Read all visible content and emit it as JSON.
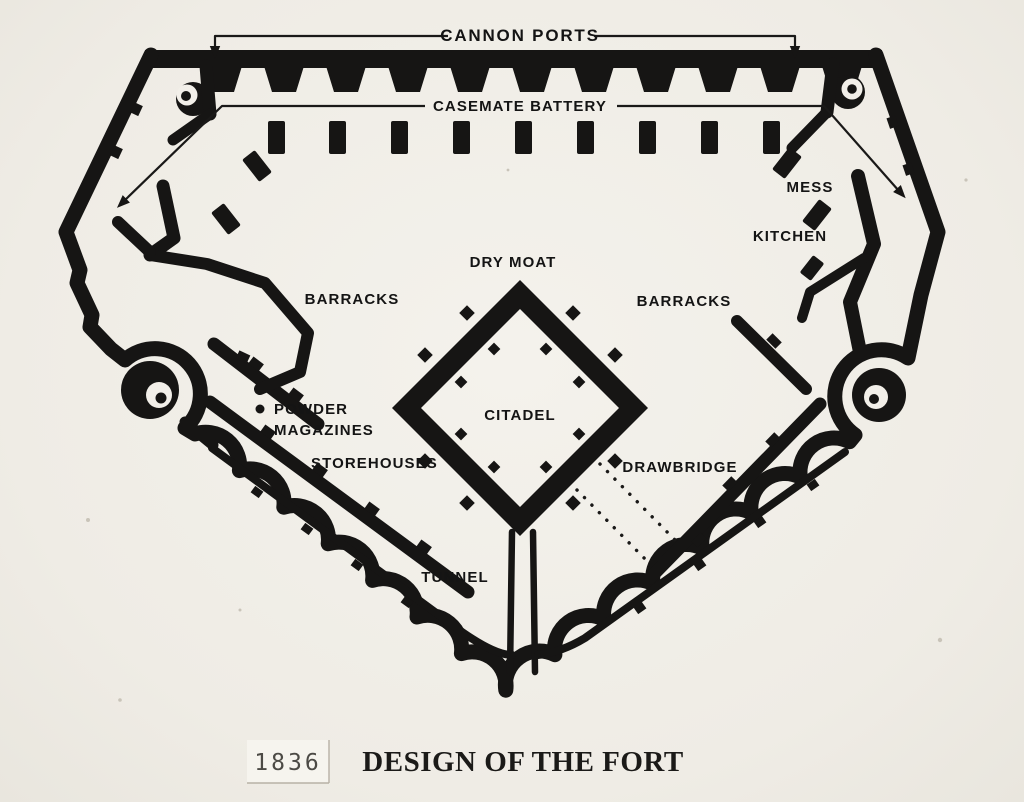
{
  "palette": {
    "paper": "#f1eee8",
    "ink": "#161514",
    "year_text": "#4c4a45",
    "year_box": "#f6f4ee"
  },
  "labels": {
    "cannon_ports": "CANNON PORTS",
    "casemate_battery": "CASEMATE BATTERY",
    "mess": "MESS",
    "kitchen": "KITCHEN",
    "dry_moat": "DRY MOAT",
    "barracks_left": "BARRACKS",
    "barracks_right": "BARRACKS",
    "citadel": "CITADEL",
    "powder_magazines": [
      "POWDER",
      "MAGAZINES"
    ],
    "storehouses": "STOREHOUSES",
    "drawbridge": "DRAWBRIDGE",
    "tunnel": "TUNNEL"
  },
  "caption": {
    "year": "1836",
    "title": "DESIGN OF THE FORT"
  }
}
